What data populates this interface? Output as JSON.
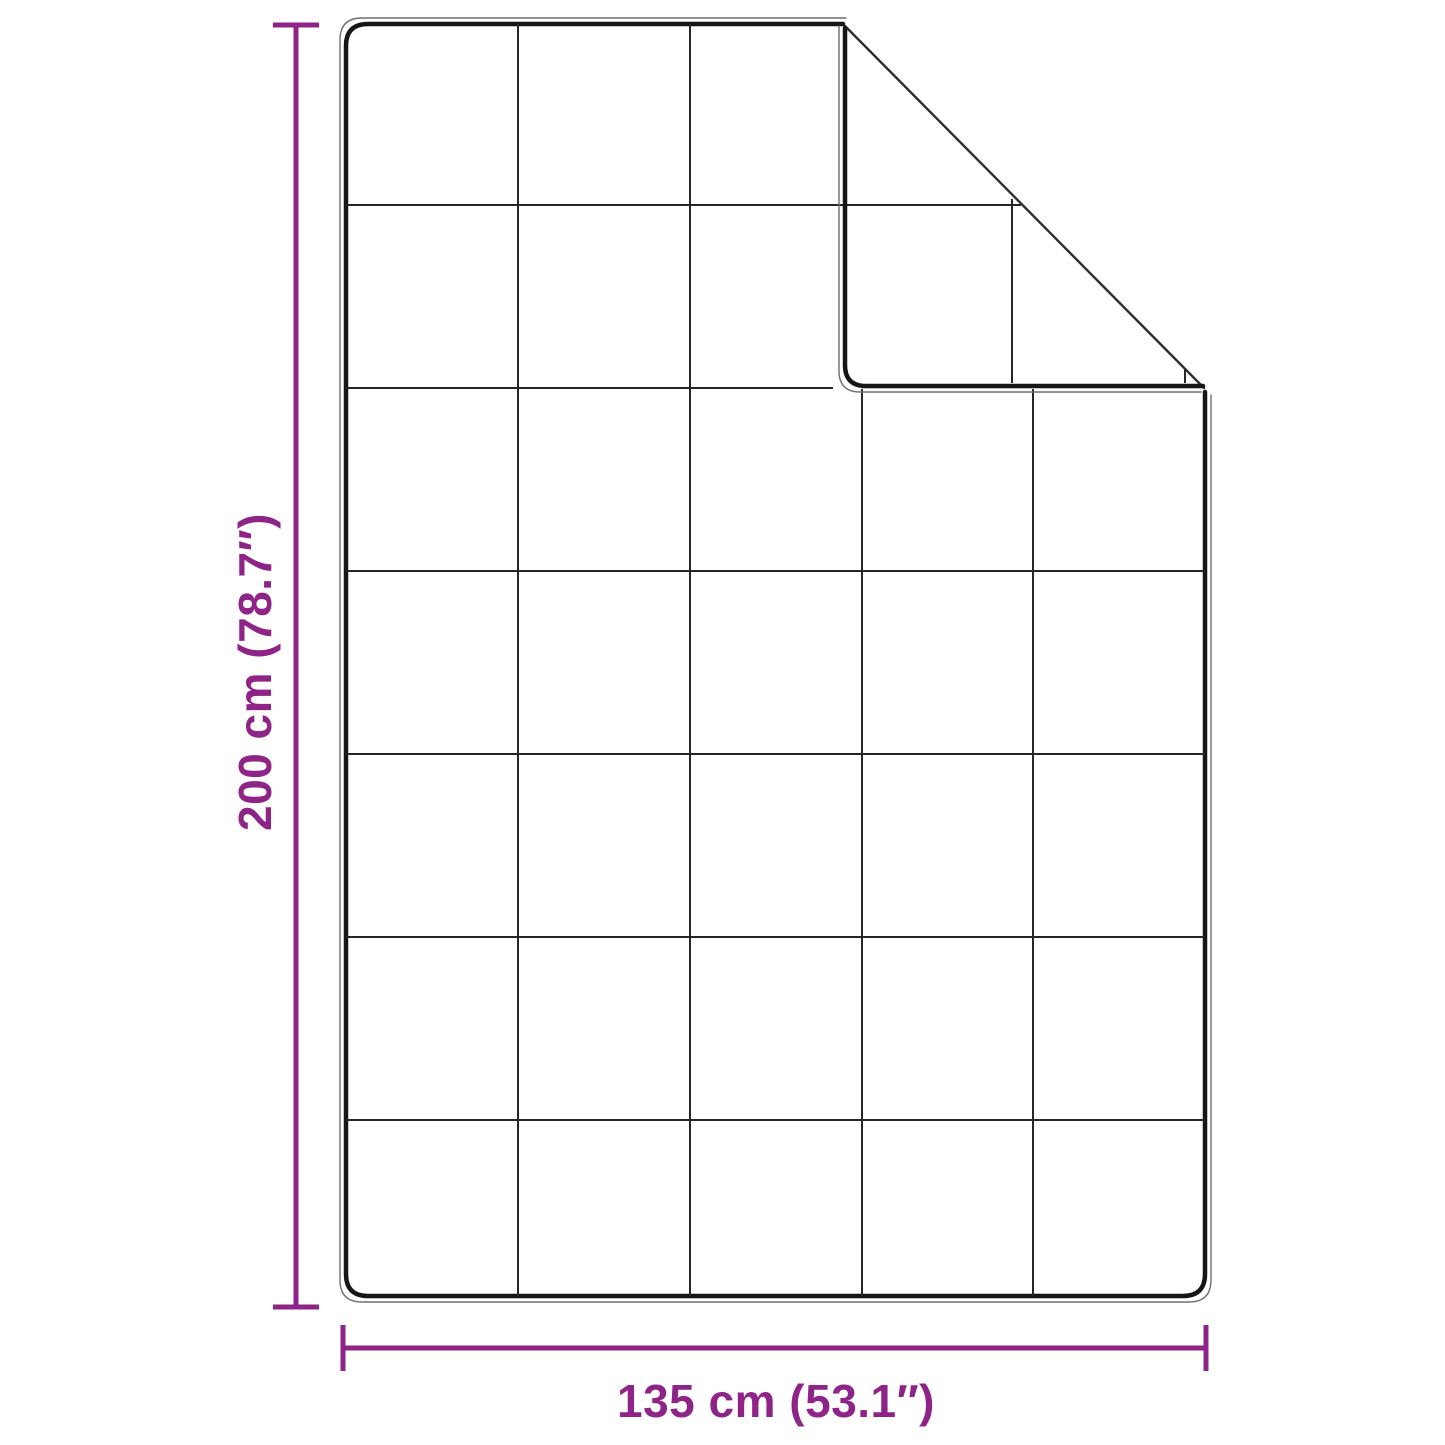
{
  "diagram": {
    "kind": "product-dimension-diagram",
    "subject": "quilted blanket with folded top-right corner",
    "height_dimension": {
      "label": "200 cm (78.7″)"
    },
    "width_dimension": {
      "label": "135 cm (53.1″)"
    },
    "grid": {
      "columns": 5,
      "rows": 7
    }
  },
  "colors": {
    "accent": "#8E2487",
    "outline": "#161616",
    "grid_line": "#262626",
    "piping": "#6f6f6f",
    "crease": "#2e2e2e",
    "background": "#ffffff"
  }
}
